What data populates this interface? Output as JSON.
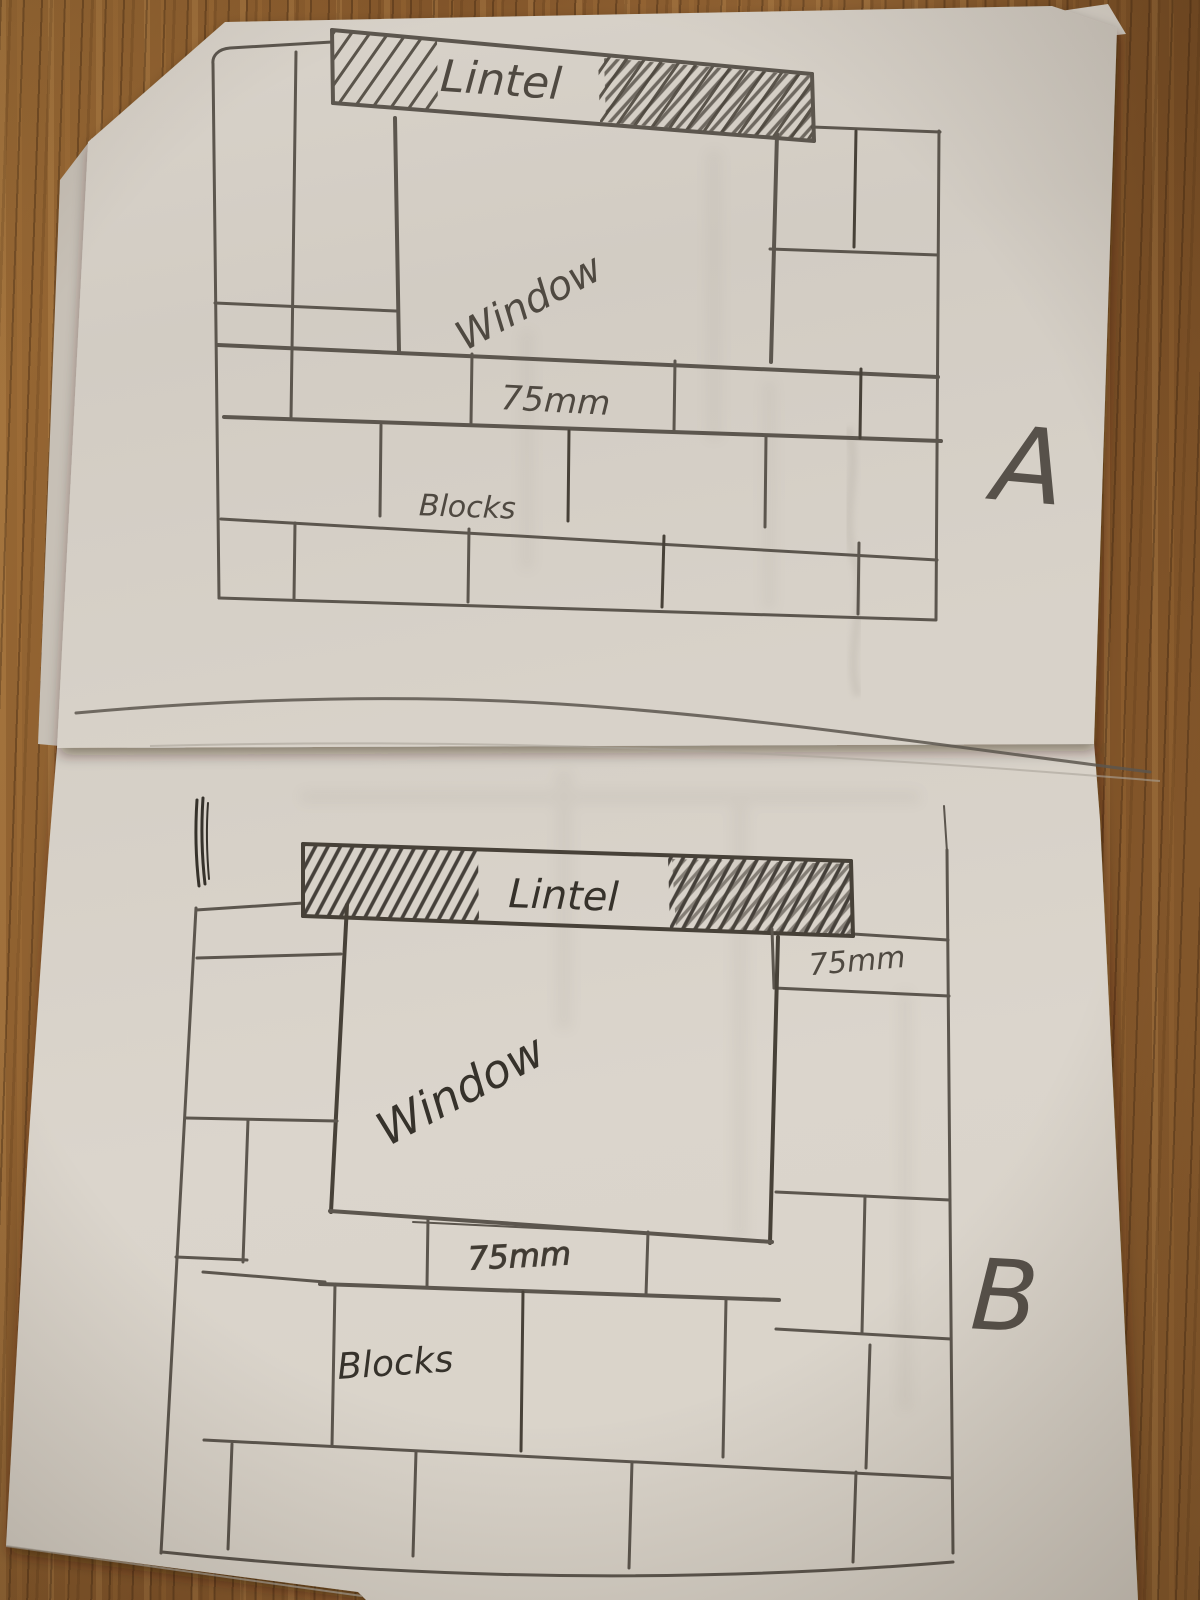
{
  "scene_title": "Hand-drawn block wall sketches with window and lintel",
  "drawing_a": {
    "letter": "A",
    "lintel_label": "Lintel",
    "window_label": "Window",
    "course_label": "75mm",
    "blocks_label": "Blocks"
  },
  "drawing_b": {
    "letter": "B",
    "lintel_label": "Lintel",
    "top_right_course_label": "75mm",
    "window_label": "Window",
    "course_label": "75mm",
    "blocks_label": "Blocks"
  },
  "colors": {
    "wood": "#8a5c2e",
    "paper": "#d6d0c7",
    "pencil": "#5c564e",
    "pencil-dark": "#474138",
    "pencil-text": "#4f4941",
    "pen": "#36322b"
  }
}
